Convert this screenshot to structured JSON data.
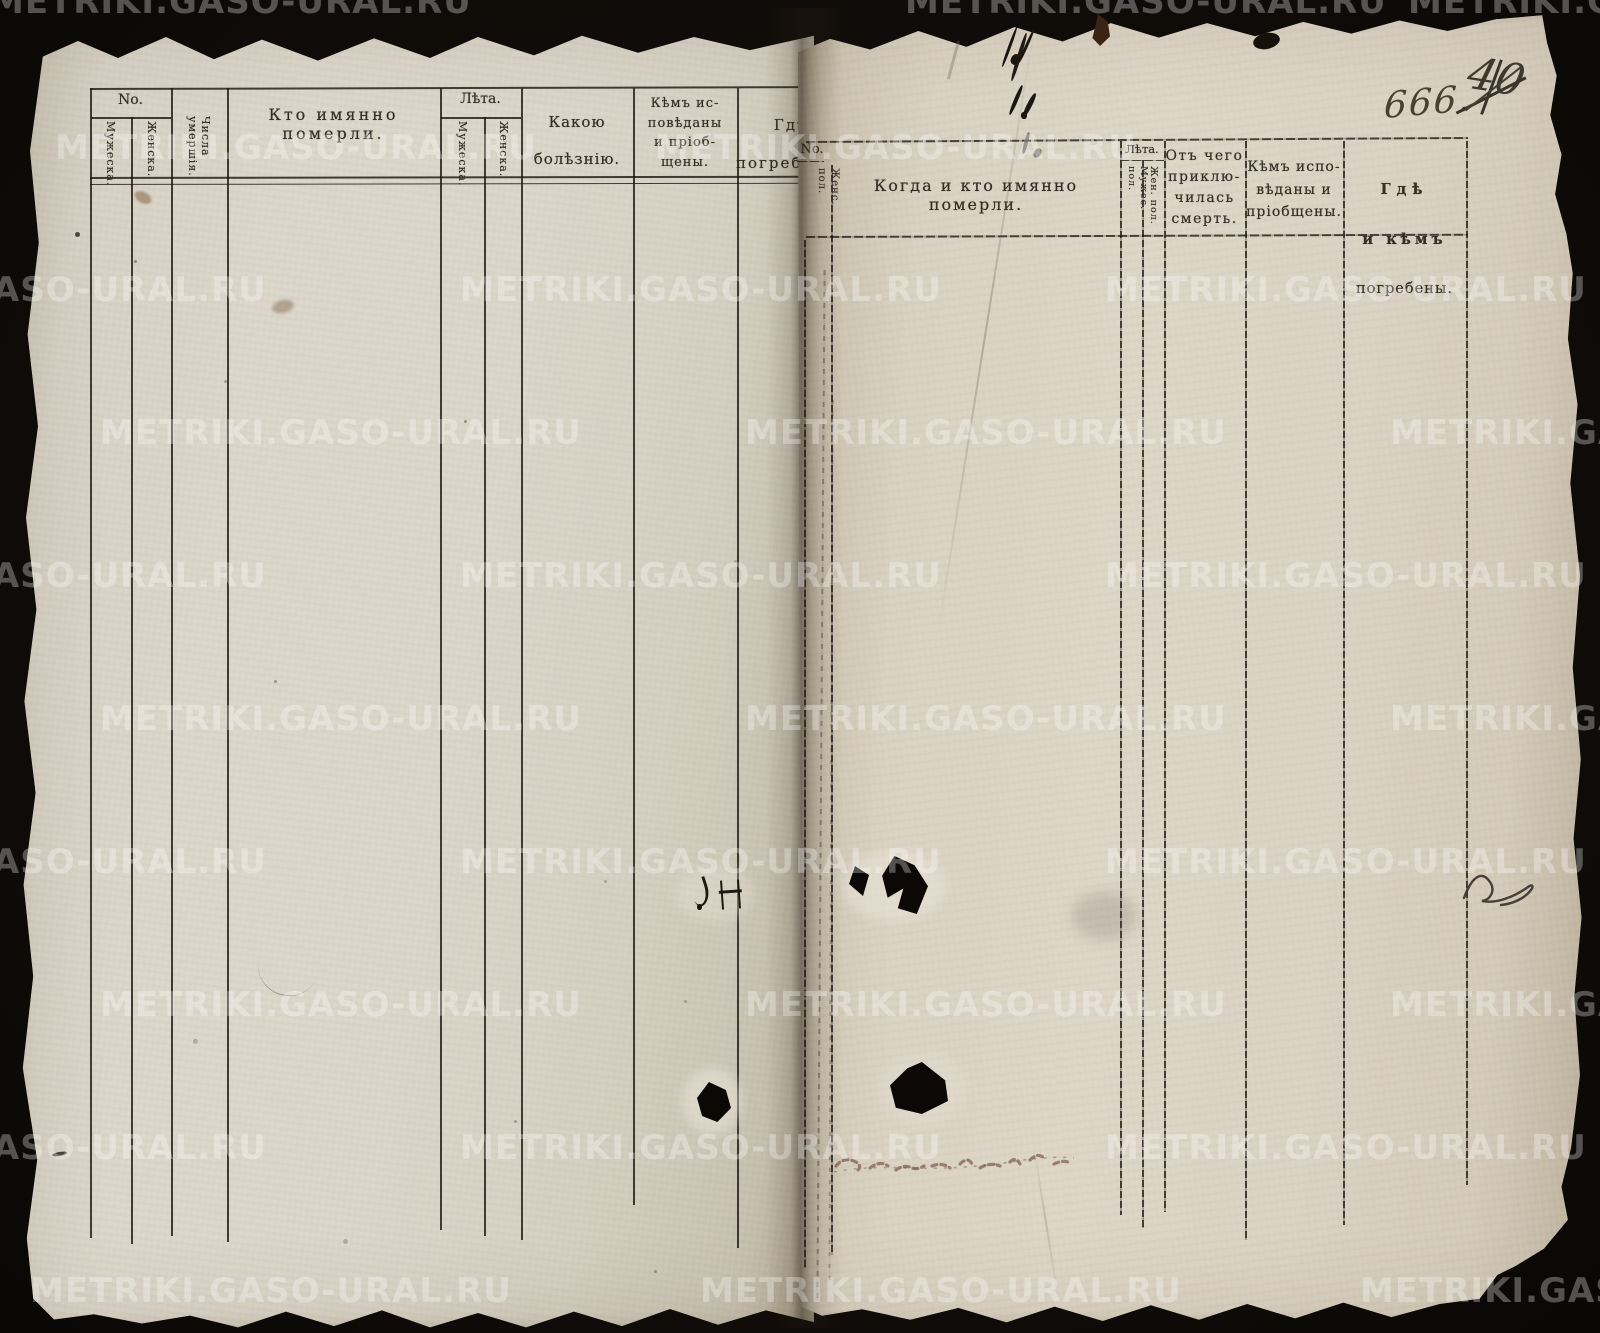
{
  "watermark": {
    "text": "METRIKI.GASO-URAL.RU"
  },
  "handwritten": {
    "page_number_ink": "666.",
    "crossed_out_number": "40"
  },
  "left_page": {
    "header": {
      "no_group": "No.",
      "no_male": "Мужеска.",
      "no_female": "Женска.",
      "death_dates": "Числа\nумершія.",
      "who_died": "Кто имянно померли.",
      "age_group": "Лѣта.",
      "age_male": "Мужеска.",
      "age_female": "Женска.",
      "illness": "Какою\nболѣзнію.",
      "confessed_communed": "Кѣмъ ис-\nповѣданы\nи пріоб-\nщены.",
      "burial_place": "Гдѣ\nпогребены."
    }
  },
  "right_page": {
    "header": {
      "no_group": "No.",
      "female_sex": "Женс. пол.",
      "when_who_died": "Когда и кто имянно померли.",
      "age_group": "Лѣта.",
      "age_male": "Мужес. пол.",
      "age_female": "Жен. пол.",
      "cause_of_death": "Отъ чего\nприклю-\nчилась\nсмерть.",
      "confessed_communed": "Кѣмъ испо-\nвѣданы и\nпріобщены.",
      "burial": [
        "Гдѣ",
        "и кѣмъ",
        "погребены."
      ]
    }
  }
}
